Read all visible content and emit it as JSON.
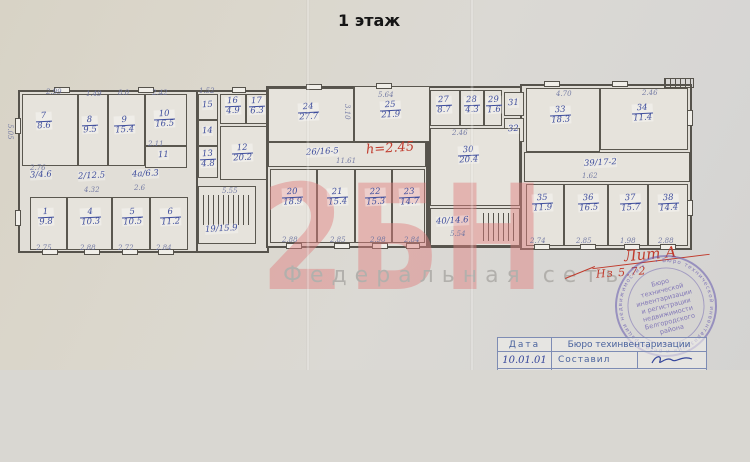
{
  "title": "1 этаж",
  "watermark": {
    "big_text": "2БН",
    "subtitle": "Федеральная сеть"
  },
  "rooms": {
    "r7": {
      "num": "7",
      "area": "8.6"
    },
    "r8": {
      "num": "8",
      "area": "9.5"
    },
    "r9": {
      "num": "9",
      "area": "15.4"
    },
    "r10": {
      "num": "10",
      "area": "16.5"
    },
    "r1": {
      "num": "1",
      "area": "9.8"
    },
    "r4": {
      "num": "4",
      "area": "10.3"
    },
    "r5": {
      "num": "5",
      "area": "10.5"
    },
    "r6": {
      "num": "6",
      "area": "11.2"
    },
    "r13": {
      "num": "13",
      "area": "4.8"
    },
    "r16": {
      "num": "16",
      "area": "4.9"
    },
    "r17": {
      "num": "17",
      "area": "6.3"
    },
    "r12": {
      "num": "12",
      "area": "20.2"
    },
    "r24": {
      "num": "24",
      "area": "27.7"
    },
    "r25": {
      "num": "25",
      "area": "21.9"
    },
    "r20": {
      "num": "20",
      "area": "18.9"
    },
    "r21": {
      "num": "21",
      "area": "15.4"
    },
    "r22": {
      "num": "22",
      "area": "15.3"
    },
    "r23": {
      "num": "23",
      "area": "14.7"
    },
    "r27": {
      "num": "27",
      "area": "8.7"
    },
    "r28": {
      "num": "28",
      "area": "4.3"
    },
    "r29": {
      "num": "29",
      "area": "1.6"
    },
    "r30": {
      "num": "30",
      "area": "20.4"
    },
    "r33": {
      "num": "33",
      "area": "18.3"
    },
    "r34": {
      "num": "34",
      "area": "11.4"
    },
    "r35": {
      "num": "35",
      "area": "11.9"
    },
    "r36": {
      "num": "36",
      "area": "16.5"
    },
    "r37": {
      "num": "37",
      "area": "15.7"
    },
    "r38": {
      "num": "38",
      "area": "14.4"
    }
  },
  "plain": {
    "p3": "3/4.6",
    "p2": "2/12.5",
    "p4a": "4а/6.3",
    "p11": "11",
    "p15": "15",
    "p14": "14",
    "p31": "31",
    "p32": "32",
    "p19": "19/15.9",
    "p26": "26/16-5",
    "p39": "39/17-2",
    "p40": "40/14.6"
  },
  "red_marks": {
    "height_note": "h=2.45",
    "lit": "Лит А",
    "h_value": "Нз  5.72"
  },
  "dims": [
    "2.99",
    "1.49",
    "8.0",
    "2.42",
    "1.52",
    "5.64",
    "4.70",
    "2.46",
    "2.46",
    "11.61",
    "5.55",
    "2.76",
    "4.32",
    "2.6",
    "2.11",
    "2.88",
    "2.85",
    "2.98",
    "2.84",
    "2.74",
    "2.85",
    "1.98",
    "2.88",
    "1.62",
    "5.54",
    "3.10",
    "5.05",
    "2.75",
    "2.88",
    "2.72",
    "2.84"
  ],
  "stamp": {
    "lines": [
      "Бюро",
      "технической",
      "инвентаризации",
      "и регистрации",
      "недвижимости",
      "Белгородского",
      "района"
    ],
    "ring_text": "• Бюро технической инвентаризации и регистрации недвижимости •"
  },
  "table": {
    "col_date": "Дата",
    "col_bureau": "Бюро техинвентаризации",
    "date_value": "10.01.01",
    "row2_label": "Составил"
  },
  "colors": {
    "ink_blue": "#3e4d9c",
    "ink_red": "#c03a2c",
    "stamp_blue": "#6a5cae",
    "watermark_pink": "#e08080"
  }
}
